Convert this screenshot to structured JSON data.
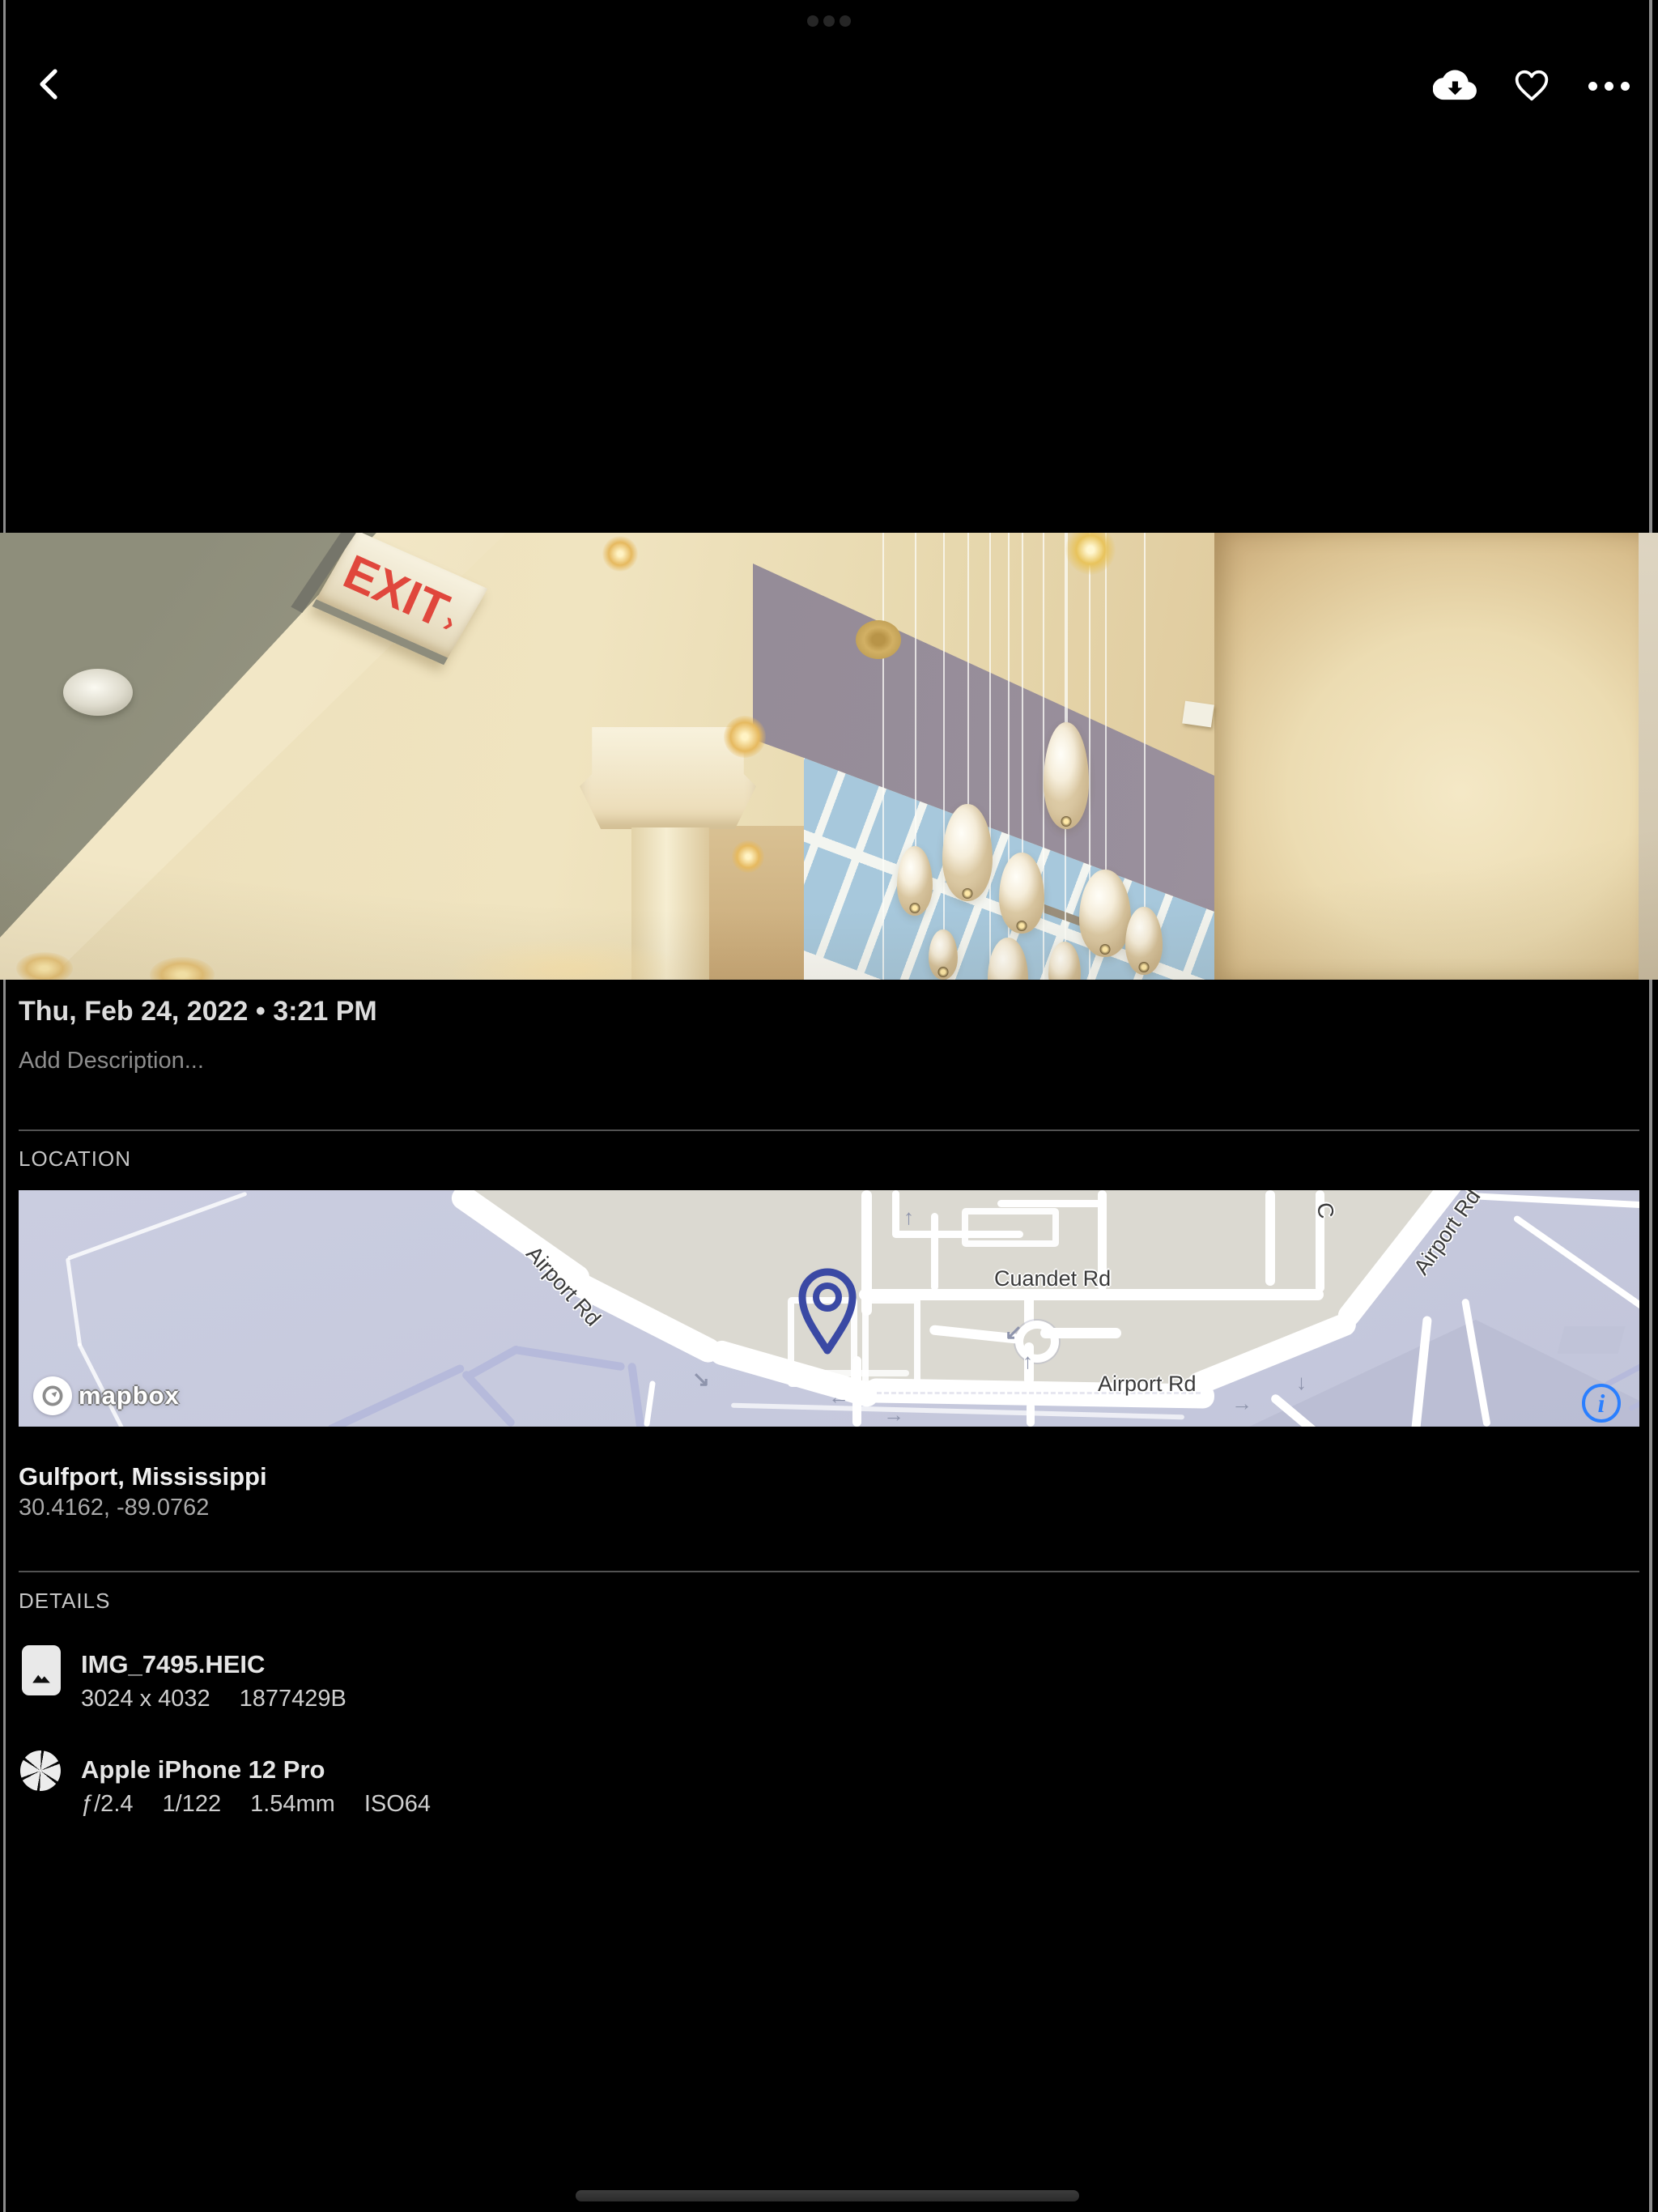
{
  "icons": {
    "back": "chevron-left-icon",
    "download": "cloud-download-icon",
    "favorite": "heart-outline-icon",
    "more": "ellipsis-icon",
    "file": "image-file-icon",
    "camera": "aperture-icon",
    "map_pin": "map-pin-icon",
    "map_info": "info-circle-icon",
    "map_attribution": "mapbox-logo-icon"
  },
  "photo": {
    "exit_sign": "EXIT",
    "exit_arrow": "›"
  },
  "meta": {
    "datetime": "Thu, Feb 24, 2022 • 3:21 PM",
    "description_placeholder": "Add Description..."
  },
  "location": {
    "label": "LOCATION",
    "place": "Gulfport, Mississippi",
    "coordinates": "30.4162, -89.0762",
    "map": {
      "labels": {
        "airport_rd_diagonal": "Airport Rd",
        "cuandet_rd": "Cuandet Rd",
        "airport_rd_horizontal": "Airport Rd",
        "airport_rd_upper_right": "Airport Rd",
        "cuandet_partial": "C"
      },
      "attribution": "mapbox",
      "info_button": "i",
      "arrows": {
        "left": "←",
        "right": "→",
        "up": "↑",
        "down": "↓",
        "down_right": "↘",
        "down_left": "↙"
      },
      "colors": {
        "land_beige": "#dbd9d1",
        "water_lavender": "#c7cade",
        "road_white": "#ffffff",
        "path_purple": "#b6badb",
        "pin_blue": "#3a49a4",
        "info_blue": "#2a7fff"
      }
    }
  },
  "details": {
    "label": "DETAILS",
    "file": {
      "name": "IMG_7495.HEIC",
      "dimensions": "3024 x 4032",
      "size": "1877429B"
    },
    "camera": {
      "name": "Apple iPhone 12 Pro",
      "aperture": "ƒ/2.4",
      "shutter_speed": "1/122",
      "focal_length": "1.54mm",
      "iso": "ISO64"
    }
  }
}
